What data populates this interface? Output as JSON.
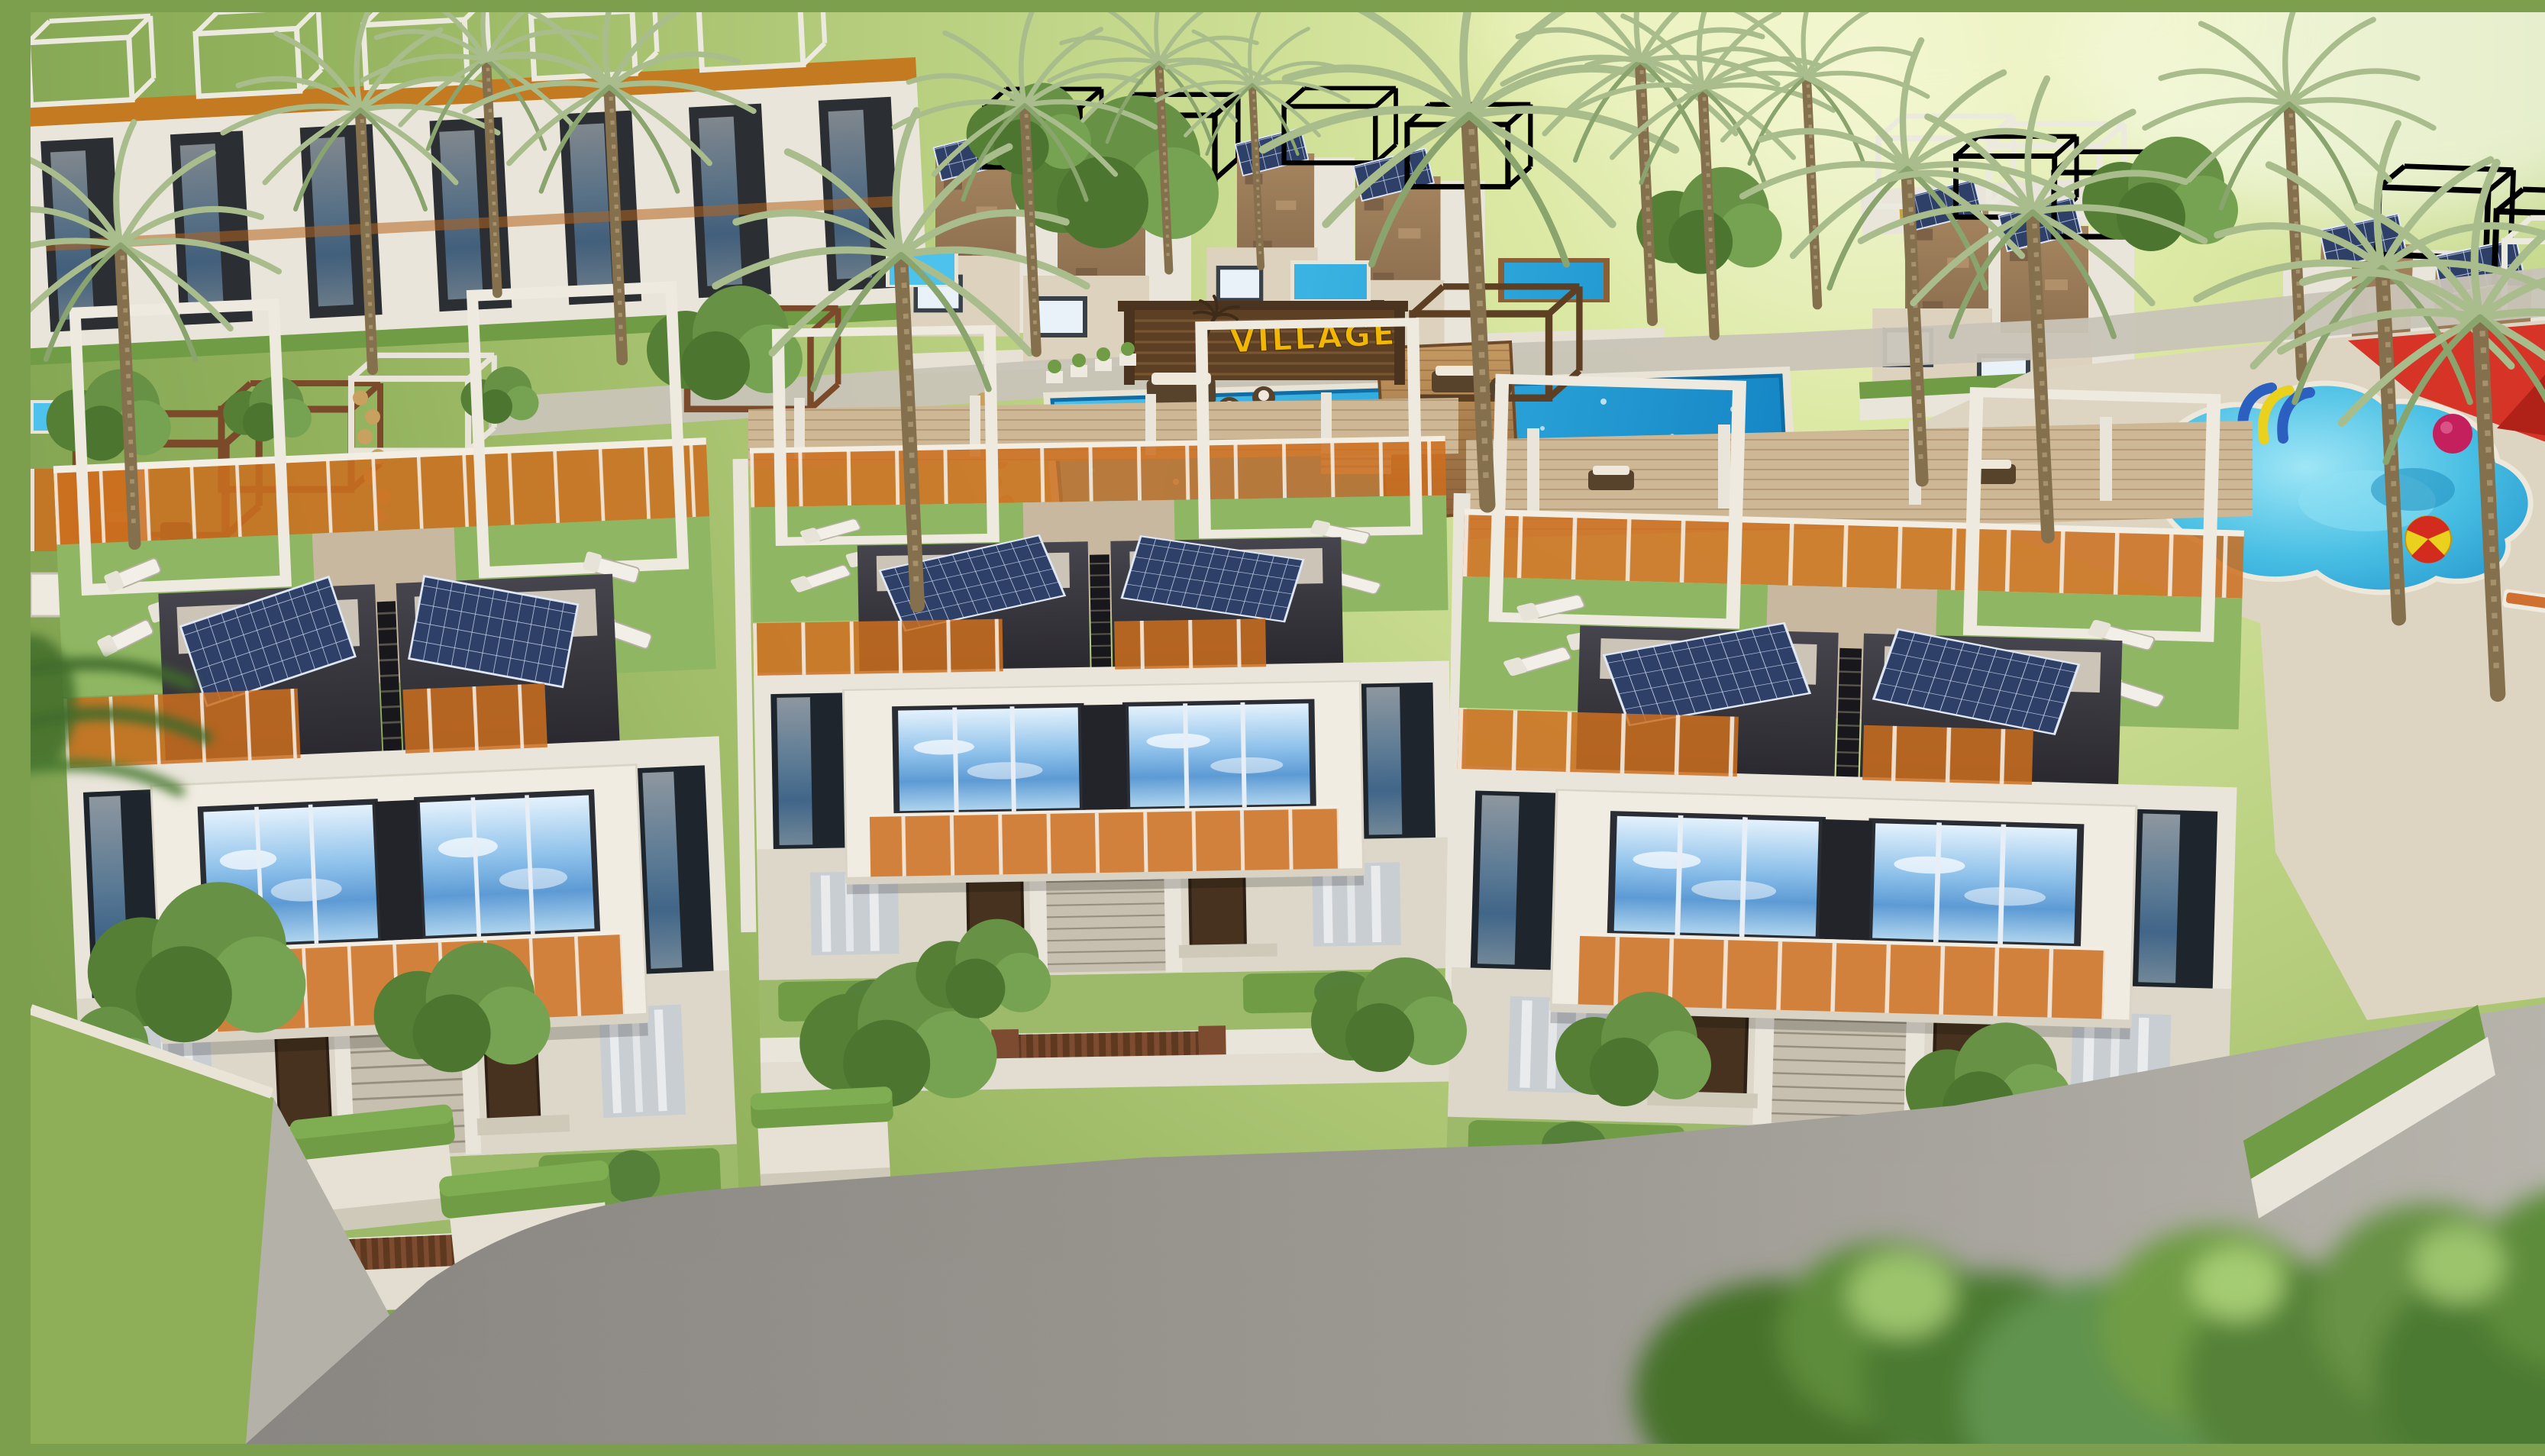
{
  "scene": {
    "type": "3d-architectural-render",
    "view": "aerial",
    "subject": "Modern townhouse resort complex with communal pools, roof terraces, solar panels and palm gardens",
    "sign": {
      "label": "VILLAGE"
    }
  },
  "colors": {
    "lawn_light": "#dcе9a4",
    "lawn_mid": "#aac873",
    "lawn_dark": "#7c9f4e",
    "grass_roof": "#8fb763",
    "pool_water": "#2fa9dc",
    "pool_water_deep": "#1484c4",
    "pool_edge": "#0e6da4",
    "kids_pool": "#49bfe4",
    "deck_wood": "#a8713f",
    "pergola_wood": "#5d4024",
    "sign_text": "#f2b705",
    "wall_white": "#e9e5da",
    "wall_shadow": "#c6c1b4",
    "dark_box": "#26252a",
    "orange_glass": "#cd6f1f",
    "window_sky": "#7db8e8",
    "window_dark": "#1f252c",
    "solar_panel": "#2e3f68",
    "road": "#95928c",
    "pavement": "#c9c4b8",
    "cream_deck": "#ddd5c2",
    "hedge": "#6f9c44",
    "bush_dark": "#4c7a31",
    "palm_frond": "#a9bd8c",
    "palm_trunk": "#84704c",
    "shade_sail_red": "#d42b1f",
    "umbrella_yellow": "#e8b423",
    "slide_blue": "#2b5fc0",
    "slide_yellow": "#ead11e",
    "ball_pink": "#c4205e",
    "lounger_white": "#f2efe8",
    "rattan": "#57422c",
    "cushion": "#efe9dc",
    "stone": "#9a7a58",
    "mustard_pad": "#c8a23c",
    "teal_lounger": "#2fb3b6"
  }
}
